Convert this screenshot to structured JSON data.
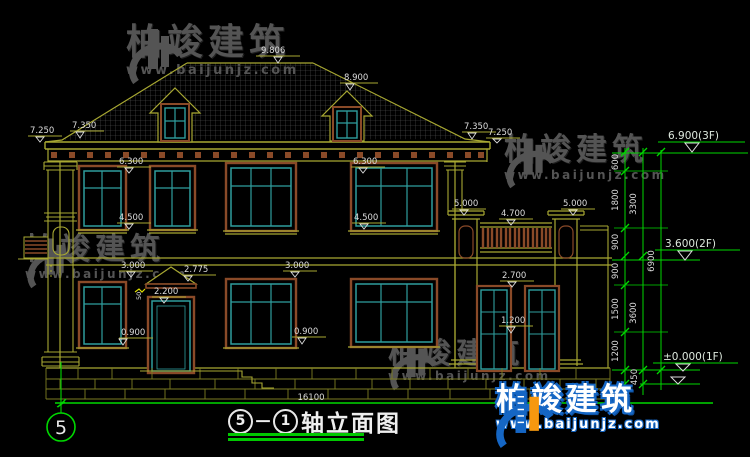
{
  "colors": {
    "line_khaki": "#a8a832",
    "stone_olive": "#7c7c22",
    "window_teal": "#2f9e9e",
    "trim_brown": "#8a4a28",
    "annotation_green": "#00d800",
    "dim_text": "#dcdcdc",
    "watermark_grey": "#6a6a6a",
    "logo_blue": "#1566c4",
    "logo_orange": "#f6980f"
  },
  "watermark": {
    "brand": "柏竣建筑",
    "url": "www.baijunjz.com"
  },
  "logo": {
    "brand": "柏竣建筑",
    "url": "www.baijunjz.com"
  },
  "title_block": {
    "axis_start": "5",
    "separator": "－",
    "axis_end": "1",
    "name": "轴立面图"
  },
  "grid_bubble": {
    "label": "5"
  },
  "ground": {
    "total_width": "16100"
  },
  "levels": {
    "l3f": "6.900(3F)",
    "l2f": "3.600(2F)",
    "l1f": "±0.000(1F)"
  },
  "dims": {
    "ridge": "9.806",
    "sub_ridge": "8.900",
    "eave_left_outer": "7.250",
    "eave_left_inner": "7.350",
    "eave_right_inner": "7.350",
    "eave_right_outer": "7.250",
    "lintel2f_left": "6.300",
    "lintel2f_right": "6.300",
    "sill2f_left": "4.500",
    "sill2f_right": "4.500",
    "pillar_left": "5.000",
    "pillar_right": "5.000",
    "railing": "4.700",
    "floor2_left": "3.000",
    "floor2_right": "3.000",
    "canopy": "2.775",
    "canopy_thk": "50",
    "door_head": "2.200",
    "sill1f_left": "0.900",
    "sill1f_right": "0.900",
    "gate_head": "2.700",
    "gate_rail": "1.200"
  },
  "chain": {
    "c600": "600",
    "c1800": "1800",
    "c900a": "900",
    "c900b": "900",
    "c1500": "1500",
    "c1200": "1200",
    "c450": "450",
    "c3300": "3300",
    "c3600": "3600",
    "c6900": "6900"
  }
}
